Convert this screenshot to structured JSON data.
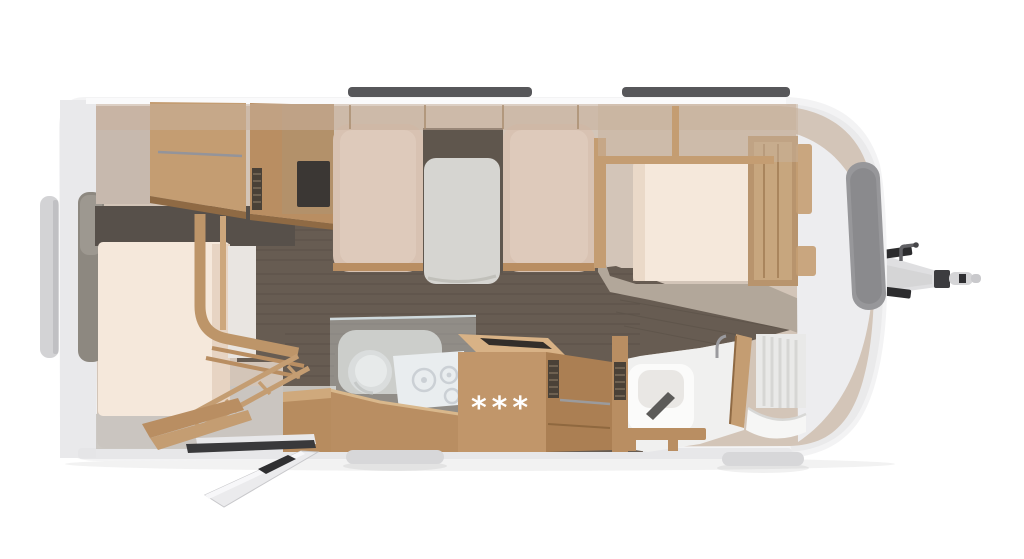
{
  "scene": {
    "description": "Top-down 3D rendered floor plan of a caravan (travel trailer) with tow hitch on the right",
    "refrigerator_badge": "***",
    "areas": [
      "rear-bunk-beds",
      "rear-window",
      "tv-panel",
      "dinette-bench-left",
      "dinette-table",
      "dinette-bench-right",
      "kitchen-sink",
      "kitchen-cooktop",
      "refrigerator",
      "entry-door-open",
      "entry-step",
      "bathroom-toilet",
      "bathroom-door",
      "shower",
      "french-bed",
      "wardrobe",
      "front-window",
      "tow-hitch",
      "roof-rails"
    ]
  },
  "colors": {
    "bg": "#ffffff",
    "shell": "#f3f3f4",
    "shellEdge": "#e9e9eb",
    "shellDark": "#d9d9db",
    "skirt": "#e4e4e6",
    "interior": "#d3c5b8",
    "band": "#c8b19c",
    "tanWall": "#c7b9ae",
    "floorDark": "#675c52",
    "plank": "#3f3830",
    "floorLight": "#c9c5c0",
    "wood": "#c49d72",
    "woodMid": "#b98e62",
    "woodDark": "#a87c50",
    "woodDeep": "#8f6a44",
    "woodLight": "#d8b286",
    "mattress": "#f5e8db",
    "mattressShade": "#e7d4c3",
    "cushion": "#d8c2b2",
    "cushionLight": "#e4d1c3",
    "table": "#d6d5d1",
    "tvDark": "#3b3734",
    "slot": "#4a4137",
    "bathFloor": "#f0f0ef",
    "fixture": "#fbfbfa",
    "fixtureShade": "#e9e7e4",
    "glass": "#dfe7ea",
    "counter": "#c2c1ba",
    "cooktop": "#eef0f2",
    "windowGlass": "#8d8880",
    "windowTab": "#d3d3d5",
    "frontWindow": "#97979a",
    "roofRail": "#57575a",
    "metal": "#9b9b9d",
    "hitch": "#dfdfe1",
    "hitchDark": "#2c2c2e",
    "coupling": "#3c3c3f",
    "doorWhite": "#ebebed",
    "badge": "#ffffff"
  }
}
